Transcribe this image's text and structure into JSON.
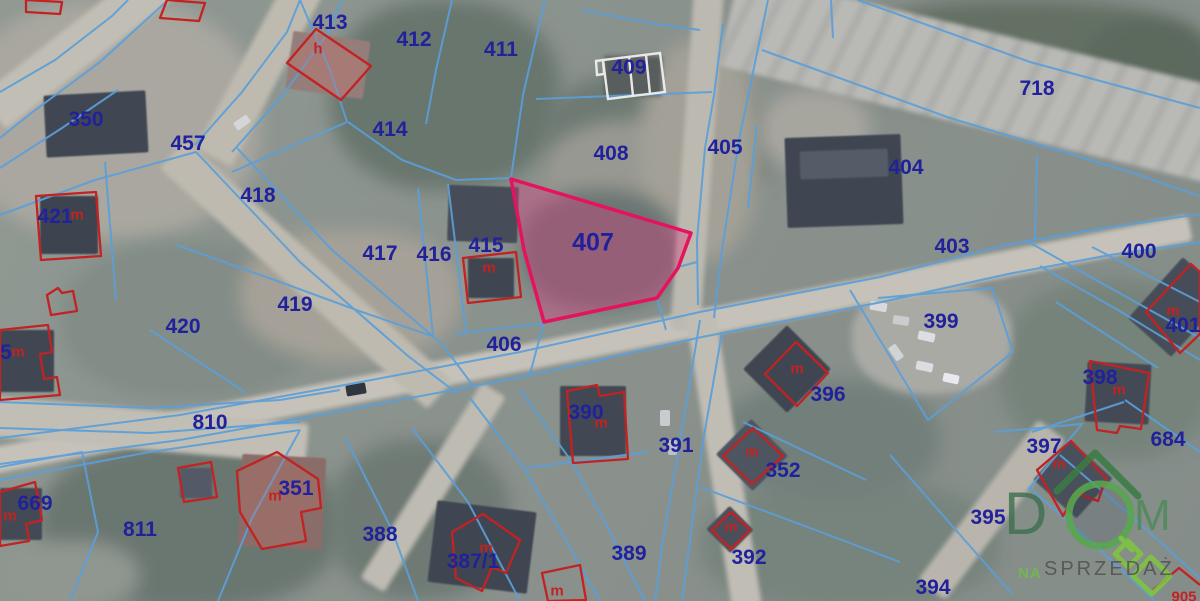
{
  "map": {
    "colors": {
      "boundary": "#5b9fd9",
      "parcel_label": "#21219b",
      "building": "#c32222",
      "highlight_stroke": "#e5135e",
      "highlight_fill": "rgba(222,60,130,0.38)"
    },
    "highlighted_parcel": "407",
    "parcel_labels": [
      {
        "text": "413",
        "x": 330,
        "y": 23
      },
      {
        "text": "412",
        "x": 414,
        "y": 40
      },
      {
        "text": "411",
        "x": 501,
        "y": 50
      },
      {
        "text": "409",
        "x": 629,
        "y": 68
      },
      {
        "text": "718",
        "x": 1037,
        "y": 89
      },
      {
        "text": "350",
        "x": 86,
        "y": 120
      },
      {
        "text": "414",
        "x": 390,
        "y": 130
      },
      {
        "text": "457",
        "x": 188,
        "y": 144
      },
      {
        "text": "405",
        "x": 725,
        "y": 148
      },
      {
        "text": "408",
        "x": 611,
        "y": 154
      },
      {
        "text": "404",
        "x": 906,
        "y": 168
      },
      {
        "text": "418",
        "x": 258,
        "y": 196
      },
      {
        "text": "421",
        "x": 55,
        "y": 217
      },
      {
        "text": "407",
        "x": 593,
        "y": 243,
        "big": true
      },
      {
        "text": "415",
        "x": 486,
        "y": 246
      },
      {
        "text": "403",
        "x": 952,
        "y": 247
      },
      {
        "text": "400",
        "x": 1139,
        "y": 252
      },
      {
        "text": "417",
        "x": 380,
        "y": 254
      },
      {
        "text": "416",
        "x": 434,
        "y": 255
      },
      {
        "text": "419",
        "x": 295,
        "y": 305
      },
      {
        "text": "399",
        "x": 941,
        "y": 322
      },
      {
        "text": "401",
        "x": 1183,
        "y": 326
      },
      {
        "text": "420",
        "x": 183,
        "y": 327
      },
      {
        "text": "406",
        "x": 504,
        "y": 345
      },
      {
        "text": "5",
        "x": 6,
        "y": 353
      },
      {
        "text": "398",
        "x": 1100,
        "y": 378
      },
      {
        "text": "396",
        "x": 828,
        "y": 395
      },
      {
        "text": "390",
        "x": 586,
        "y": 413
      },
      {
        "text": "810",
        "x": 210,
        "y": 423
      },
      {
        "text": "684",
        "x": 1168,
        "y": 440
      },
      {
        "text": "391",
        "x": 676,
        "y": 446
      },
      {
        "text": "397",
        "x": 1044,
        "y": 447
      },
      {
        "text": "352",
        "x": 783,
        "y": 471
      },
      {
        "text": "351",
        "x": 296,
        "y": 489
      },
      {
        "text": "669",
        "x": 35,
        "y": 504
      },
      {
        "text": "395",
        "x": 988,
        "y": 518
      },
      {
        "text": "811",
        "x": 140,
        "y": 530
      },
      {
        "text": "388",
        "x": 380,
        "y": 535
      },
      {
        "text": "389",
        "x": 629,
        "y": 554
      },
      {
        "text": "392",
        "x": 749,
        "y": 558
      },
      {
        "text": "387/1",
        "x": 473,
        "y": 562
      },
      {
        "text": "394",
        "x": 933,
        "y": 588
      }
    ],
    "building_labels": [
      {
        "text": "h",
        "x": 318,
        "y": 49
      },
      {
        "text": "m",
        "x": 77,
        "y": 215
      },
      {
        "text": "m",
        "x": 489,
        "y": 268
      },
      {
        "text": "m",
        "x": 1173,
        "y": 311
      },
      {
        "text": "m",
        "x": 18,
        "y": 352
      },
      {
        "text": "m",
        "x": 797,
        "y": 369
      },
      {
        "text": "m",
        "x": 1119,
        "y": 390
      },
      {
        "text": "m",
        "x": 601,
        "y": 423
      },
      {
        "text": "m",
        "x": 752,
        "y": 452
      },
      {
        "text": "m",
        "x": 1059,
        "y": 464
      },
      {
        "text": "m",
        "x": 275,
        "y": 496
      },
      {
        "text": "m",
        "x": 10,
        "y": 516
      },
      {
        "text": "m",
        "x": 731,
        "y": 527
      },
      {
        "text": "m",
        "x": 486,
        "y": 548
      },
      {
        "text": "m",
        "x": 557,
        "y": 591
      },
      {
        "text": "905",
        "x": 1184,
        "y": 597
      }
    ]
  },
  "watermark": {
    "letter_d": "D",
    "letter_m": "M",
    "tagline_prefix": "NA",
    "tagline": "SPRZEDAŻ",
    "colors": {
      "letters": "#3f7050",
      "letter_m": "#4d8a58",
      "roof": "#3c7c44",
      "circle": "#57a74f",
      "key": "#7fc53e",
      "prefix": "#6fbf45",
      "tagline": "#4e4e4e"
    }
  }
}
